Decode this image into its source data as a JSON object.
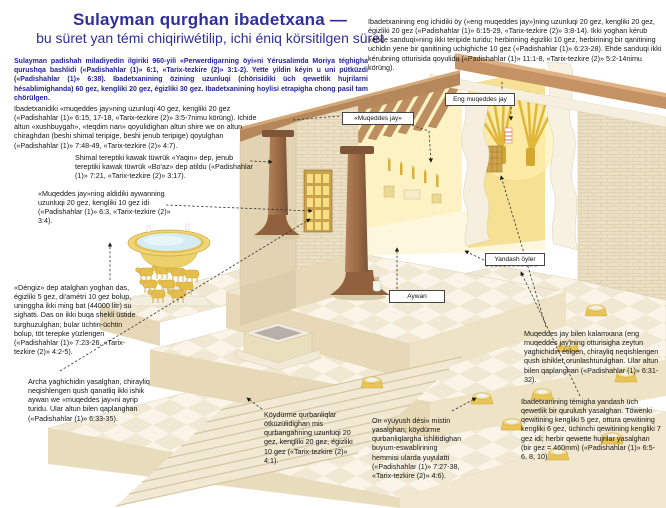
{
  "title": {
    "line1": "Sulayman qurghan ibadetxana —",
    "line2": "bu süret yan témi chiqiriwétilip, ichi éniq körsitilgen süret"
  },
  "intro": "Sulayman padishah miladiyedin ilgiriki 960-yili «Perwerdigarning öyi»ni Yérusalimda Moriya téghigha qurushqa bashlidi («Padishahlar (1)» 6:1, «Tarix-tezkire (2)» 3:1-2). Yette yildin kéyin u uni pütküzdi («Padishahlar (1)» 6:38). Ibadetxanining özining uzunluqi (chörisidiki üch qewetlik hujrilarni hésablimighanda) 60 gez, kengliki 20 gez, égizliki 30 gez. Ibadetxanining hoylisi etrapigha chong pasil tam chörülgen.",
  "callouts": {
    "muqeddes_jay": "Ibadetxanidiki «muqeddes jay»ning uzunluqi 40 gez, kengliki 20 gez («Padishahlar (1)» 6:15, 17-18, «Tarix-tezkire (2)» 3:5-7nimu körüng). Ichide altun «xushbuygah», «teqdim nan» qoyulidighan altun shire we on altun chiraghdan (beshi shimal teripige, beshi jenub teripige) qoyulghan («Padishahlar (1)» 7:48-49, «Tarix-tezkire (2)» 4:7).",
    "tuwruk": "Shimal tereptiki kawak tüwrük «Yaqin» dep, jenub tereptiki kawak tüwrük «Bo'az» dep atildu («Padishahlar (1)» 7:21, «Tarix-tezkire (2)» 3:17).",
    "aywan": "«Muqeddes jay»ning aldidiki aywanning uzunluqi 20 gez, kengliki 10 gez idi («Padishahlar (1)» 6:3, «Tarix-tezkire (2)» 3:4).",
    "dengiz": "«Déngiz» dep atalghan yoghan das, égizliki 5 gez, di'amétri 10 gez bolup, uninggha ikki ming bat (44000 litr) su sighatti. Das on ikki buqa shekli üstide turghuzulghan; bular üchtin-üchtin bolup, töt terepke yüzlengen («Padishahlar (1)» 7:23-26, «Tarix-tezkire (2)» 4:2-5).",
    "ishik": "Archa yaghichidin yasalghan, chirayliq neqishlengen qush qanatliq ikki ishik aywan we «muqeddes jay»ni ayrip turidu. Ular altun bilen qaplanghan («Padishahlar (1)» 6:33-35).",
    "qurbangah": "Köydürme qurbanliqlar ötküzülidighan mis qurbangahning uzunluqi 20 gez, kengliki 20 gez, égizliki 10 gez («Tarix-tezkire (2)» 4:1).",
    "yuyush_desi": "On «yuyush dési» mistin yasalghan; köydürme qurbanliqlargha ishlitidighan buyum-eswablirining hemmisi ularda yuyulatti («Padishahlar (1)» 7:27-38, «Tarix-tezkire (2)» 4:6).",
    "eng_muqeddes_jay": "Ibadetxanining eng ichidiki öy («eng muqeddes jay»)ning uzunluqi 20 gez, kengliki 20 gez, égizliki 20 gez («Padishahlar (1)» 6:15-29, «Tarix-tezkire (2)» 3:8-14). Ikki yoghan kérub «ehde sanduqi»ning ikki teripide turidu; herbirining égizliki 10 gez, herbirining bir qanitining uchidin yene bir qanitining uchighiche 10 gez («Padishahlar (1)» 6:23-28). Ehde sanduqi ikki kérubning otturisida qoyulidu («Padishahlar (1)» 11:1-8, «Tarix-tezkire (2)» 5:2-14nimu körüng).",
    "kalamxana_ishik": "Muqeddes jay bilen kalamxana (eng muqeddes jay)ning otturisigha zeytun yaghichidin étilgen, chirayliq neqishlengen qush ishikler orunlashturulghan. Ular altun bilen qaplanghan («Padishahlar (1)» 6:31-32).",
    "yandash_qurulush": "Ibadetxanining témigha yandash üch qewetlik bir qurulush yasalghan. Töwenki qewitining kengliki 5 gez, ottura qewitining kengliki 6 gez, üchinchi qewitining kengliki 7 gez idi; herbir qewette hujrilar yasalghan (bir gez = 460mm) («Padishahlar (1)» 6:5-6, 8, 10)"
  },
  "labels": {
    "eng_muqeddes_jay": "Eng muqeddes jay",
    "muqeddes_jay": "«Muqeddes jay»",
    "yandash_oyler": "Yandash öyler",
    "aywan": "Aywan"
  },
  "colors": {
    "title_blue": "#2e2e9f",
    "intro_navy": "#23239a",
    "stone_cream": "#ece0c4",
    "wood_tan": "#b5875a",
    "gold": "#eac75a",
    "water_blue": "#d5ecf5"
  }
}
